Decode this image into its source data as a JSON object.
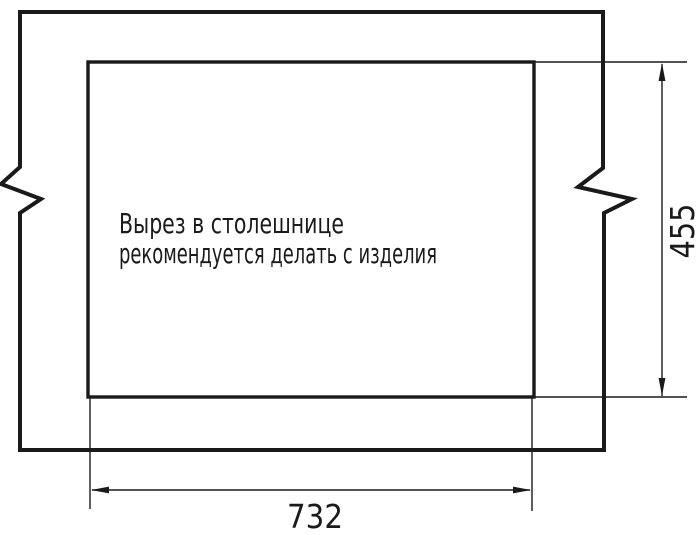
{
  "drawing": {
    "note": {
      "line1": "Вырез в столешнице",
      "line2": "рекомендуется делать с изделия"
    },
    "dimensions": {
      "width_label": "732",
      "height_label": "455"
    },
    "colors": {
      "line": "#1a1a1a",
      "background": "#ffffff"
    }
  }
}
